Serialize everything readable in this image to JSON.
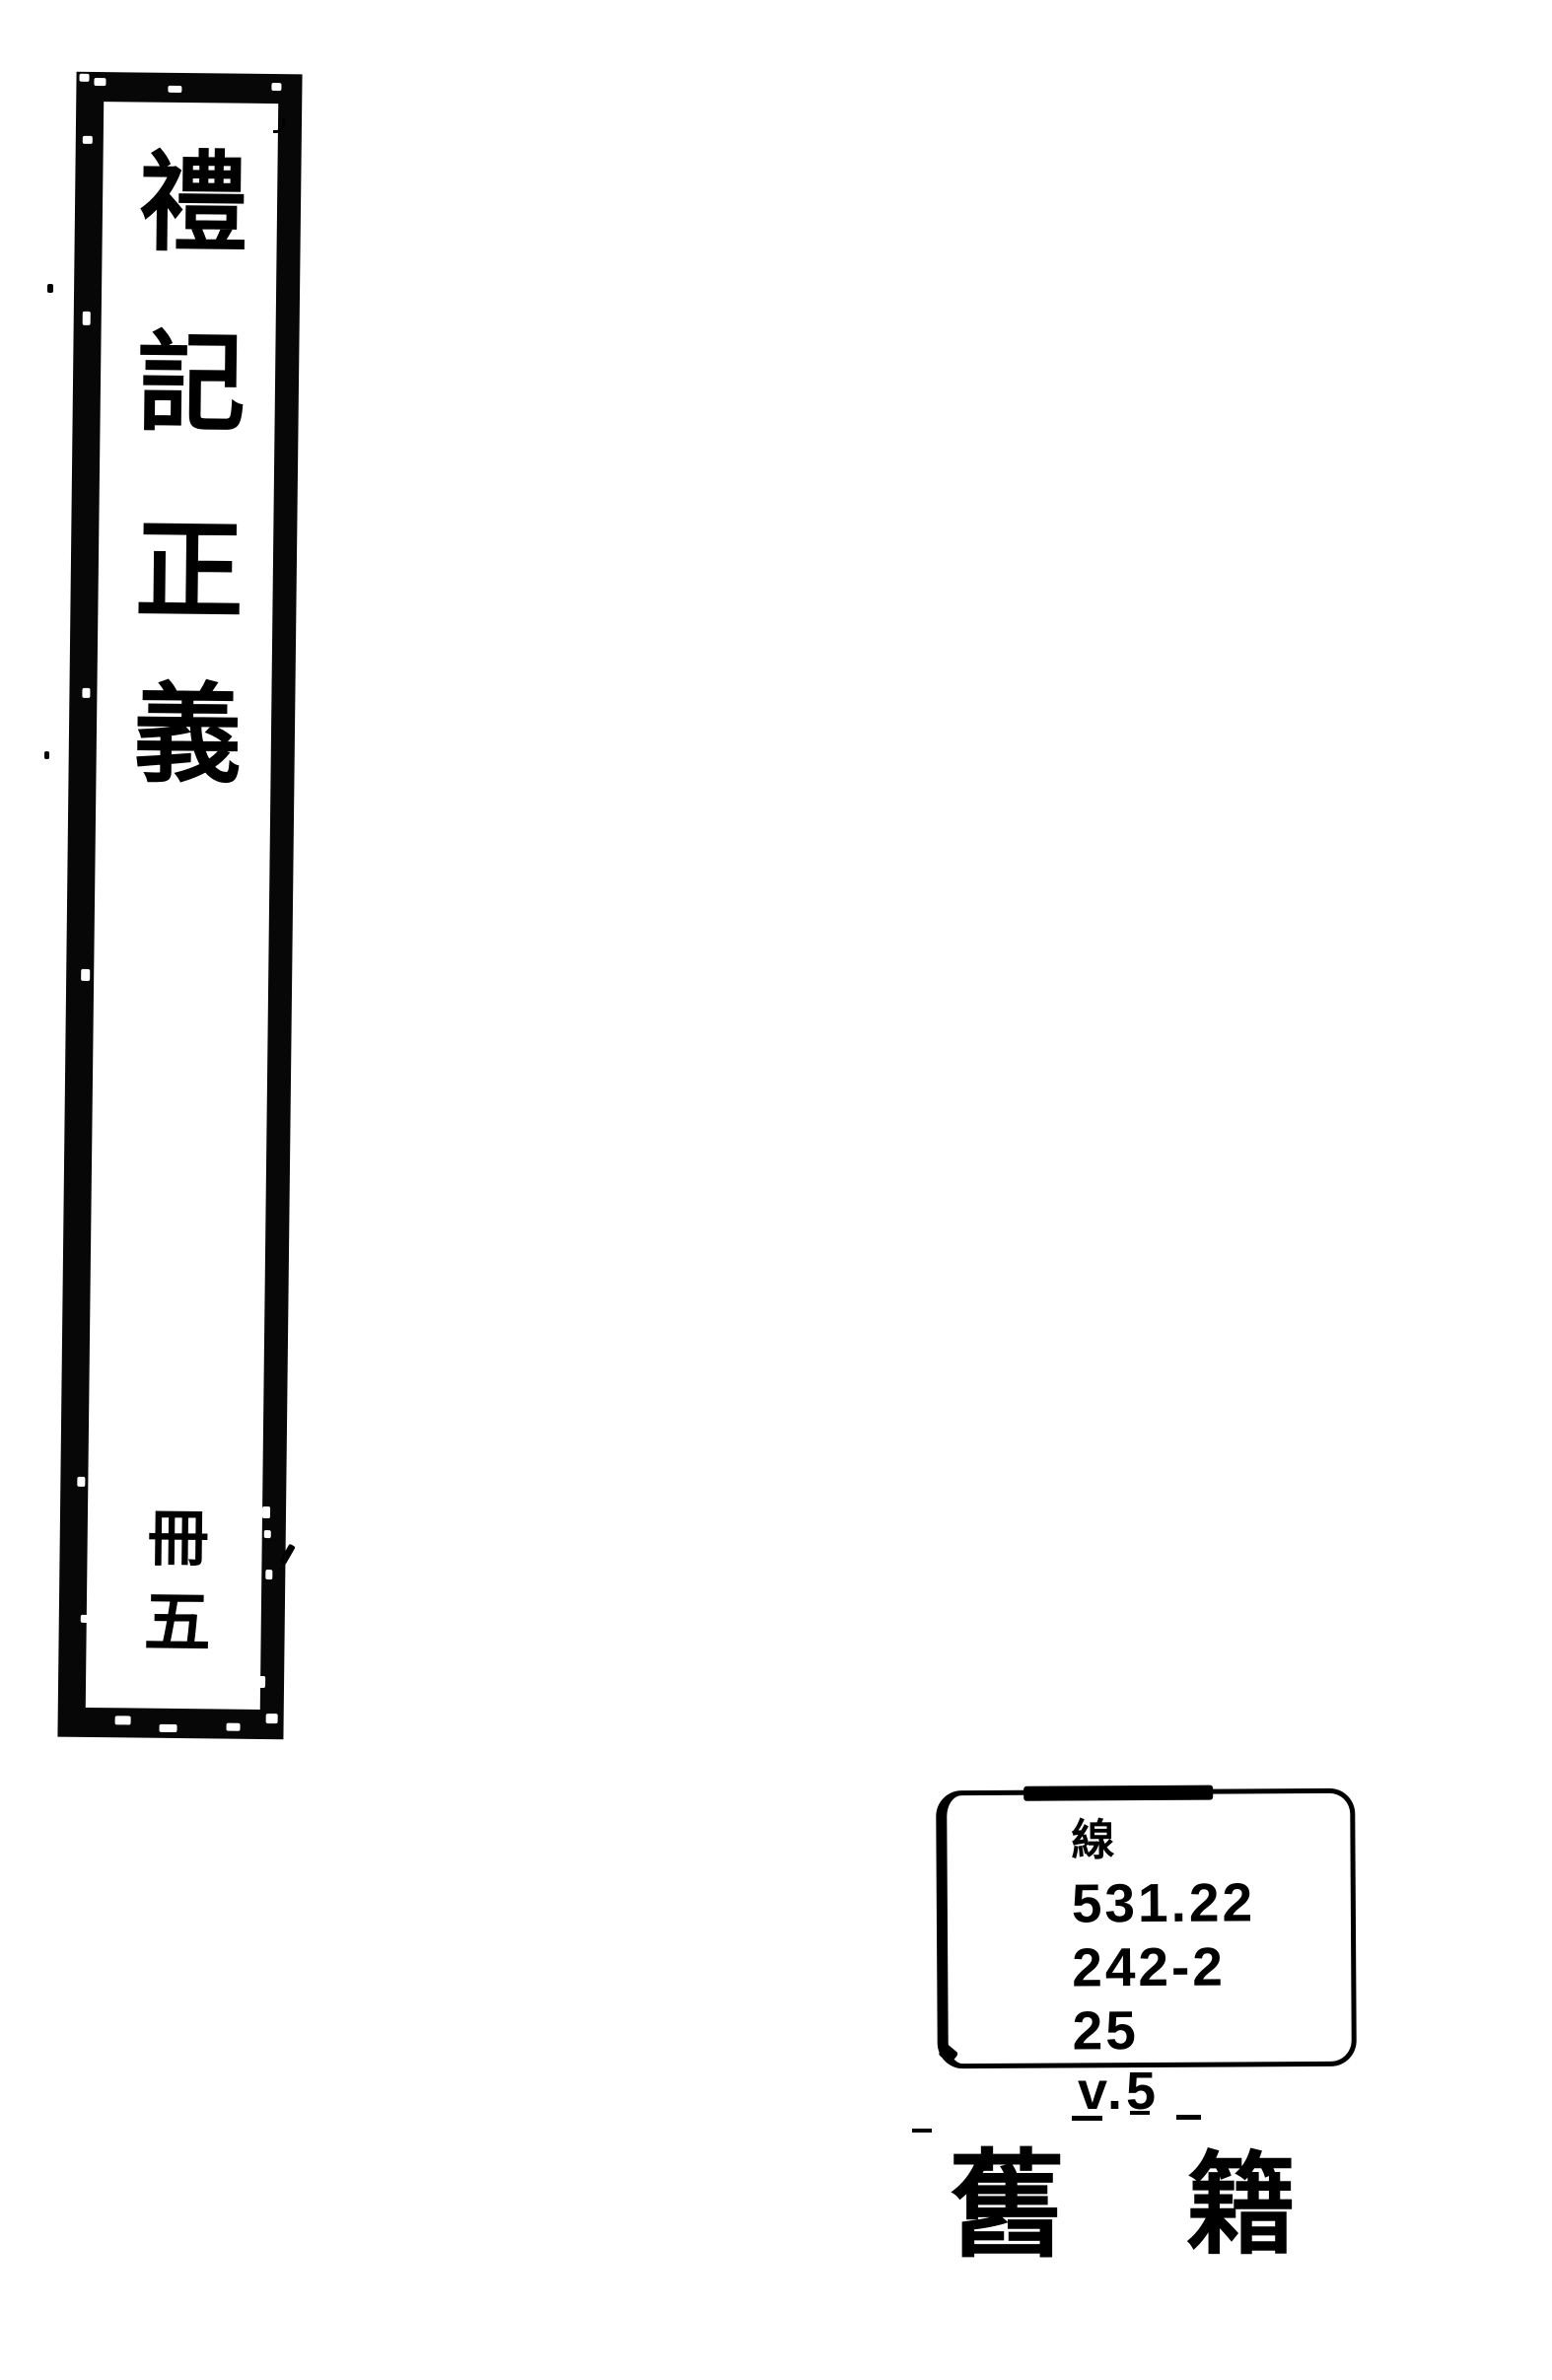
{
  "page": {
    "paper_color": "#ffffff",
    "ink_color": "#000000"
  },
  "spine_label": {
    "title": "禮記正義",
    "title_chars": [
      "禮",
      "記",
      "正",
      "義"
    ],
    "volume": "冊五",
    "volume_chars": [
      "冊",
      "五"
    ]
  },
  "call_number_label": {
    "lines": [
      "線",
      "531.22",
      "242-2",
      "25"
    ],
    "volume_text": "v.5"
  },
  "category_stamp": {
    "text": "舊籍",
    "chars": [
      "舊",
      "籍"
    ]
  }
}
